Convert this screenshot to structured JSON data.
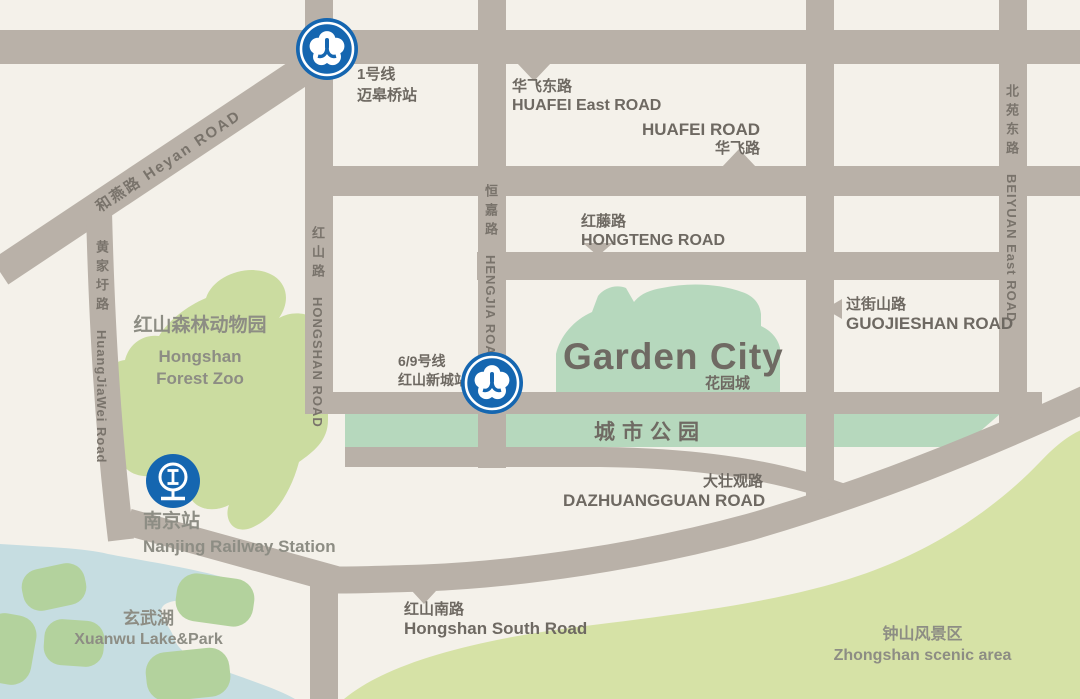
{
  "colors": {
    "bg": "#f4f1ea",
    "road": "#b9b1a8",
    "lake": "#c6dde1",
    "island": "#b3d29d",
    "zoo": "#cbdca0",
    "scenic": "#d6e2a6",
    "mint": "#b6d8bd",
    "metro_blue": "#1566b0",
    "label_gray": "#6e6962",
    "road_label_gray": "#79736b",
    "area_label_gray": "#8d8d84"
  },
  "stations": {
    "maigaoqiao": {
      "line": "1号线",
      "name": "迈皋桥站"
    },
    "hongshanxincheng": {
      "line": "6/9号线",
      "name": "红山新城站"
    },
    "nanjing": {
      "zh": "南京站",
      "en": "Nanjing Railway Station"
    }
  },
  "roads": {
    "heyan": {
      "label": "和燕路  Heyan  ROAD"
    },
    "huangjiawei": {
      "zh": "黄家圩路",
      "en": "HuangJiaWei Road"
    },
    "hongshan": {
      "zh": "红山路",
      "en": "HONGSHAN ROAD"
    },
    "hengjia": {
      "zh": "恒嘉路",
      "en": "HENGJIA ROAD"
    },
    "beiyuan": {
      "zh": "北苑东路",
      "en": "BEIYUAN East ROAD"
    },
    "huafei_east": {
      "zh": "华飞东路",
      "en": "HUAFEI  East  ROAD"
    },
    "huafei": {
      "en": "HUAFEI  ROAD",
      "zh": "华飞路"
    },
    "hongteng": {
      "zh": "红藤路",
      "en": "HONGTENG  ROAD"
    },
    "guojieshan": {
      "zh": "过街山路",
      "en": "GUOJIESHAN  ROAD"
    },
    "dazhuangguan": {
      "zh": "大壮观路",
      "en": "DAZHUANGGUAN ROAD"
    },
    "hongshan_south": {
      "zh": "红山南路",
      "en": "Hongshan South Road"
    }
  },
  "places": {
    "zoo": {
      "zh": "红山森林动物园",
      "en1": "Hongshan",
      "en2": "Forest Zoo"
    },
    "garden_city": {
      "en": "Garden City",
      "zh": "花园城"
    },
    "city_park": {
      "zh": "城市公园"
    },
    "xuanwu": {
      "zh": "玄武湖",
      "en": "Xuanwu  Lake&Park"
    },
    "zhongshan": {
      "zh": "钟山风景区",
      "en": "Zhongshan scenic area"
    }
  }
}
